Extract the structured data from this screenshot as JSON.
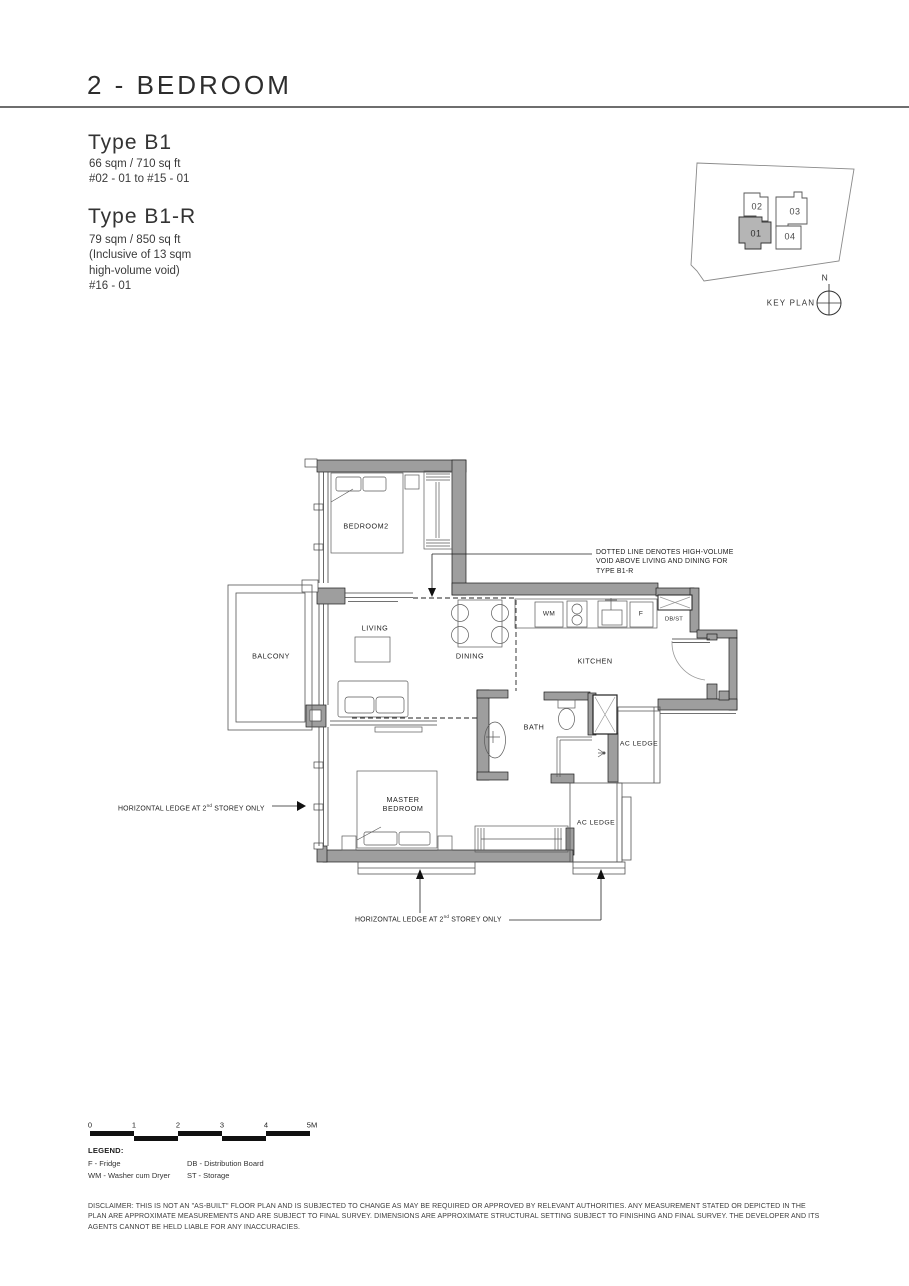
{
  "header": {
    "title": "2 - BEDROOM"
  },
  "unit_types": [
    {
      "name": "Type B1",
      "area": "66 sqm / 710 sq ft",
      "levels": "#02 - 01 to #15 - 01"
    },
    {
      "name": "Type B1-R",
      "area": "79 sqm / 850 sq ft",
      "note1": "(Inclusive of 13 sqm",
      "note2": "high-volume void)",
      "levels": "#16 - 01"
    }
  ],
  "key_plan": {
    "title": "KEY PLAN",
    "north": "N",
    "units": [
      "02",
      "03",
      "01",
      "04"
    ],
    "highlighted_unit": "01"
  },
  "floor_plan": {
    "rooms": {
      "bedroom2": "BEDROOM2",
      "living": "LIVING",
      "dining": "DINING",
      "kitchen": "KITCHEN",
      "balcony": "BALCONY",
      "bath": "BATH",
      "master_bedroom": "MASTER BEDROOM",
      "ac_ledge_upper": "AC LEDGE",
      "ac_ledge_lower": "AC LEDGE"
    },
    "fixtures": {
      "washer": "WM",
      "fridge": "F",
      "db_storage": "DB/ST"
    },
    "annotations": {
      "void_note_line1": "DOTTED LINE DENOTES HIGH-VOLUME",
      "void_note_line2": "VOID ABOVE LIVING AND DINING FOR",
      "void_note_line3": "TYPE B1-R",
      "ledge_note_prefix": "HORIZONTAL LEDGE AT 2",
      "ledge_note_sup": "nd",
      "ledge_note_suffix": " STOREY ONLY"
    }
  },
  "scale_bar": {
    "labels": [
      "0",
      "1",
      "2",
      "3",
      "4",
      "5M"
    ]
  },
  "legend": {
    "title": "LEGEND:",
    "col1": [
      "F - Fridge",
      "WM - Washer cum Dryer"
    ],
    "col2": [
      "DB - Distribution Board",
      "ST - Storage"
    ]
  },
  "disclaimer": "DISCLAIMER: THIS IS NOT AN \"AS-BUILT\" FLOOR PLAN AND IS SUBJECTED TO CHANGE AS MAY BE REQUIRED OR APPROVED BY RELEVANT AUTHORITIES. ANY MEASUREMENT STATED OR DEPICTED IN THE PLAN ARE APPROXIMATE MEASUREMENTS AND ARE SUBJECT TO FINAL SURVEY. DIMENSIONS ARE APPROXIMATE STRUCTURAL SETTING SUBJECT TO FINISHING AND FINAL SURVEY. THE DEVELOPER AND ITS AGENTS CANNOT BE HELD LIABLE FOR ANY INACCURACIES.",
  "colors": {
    "wall_fill": "#9e9e9e",
    "line": "#1c1c1c",
    "key_highlight": "#b5b5b5"
  }
}
